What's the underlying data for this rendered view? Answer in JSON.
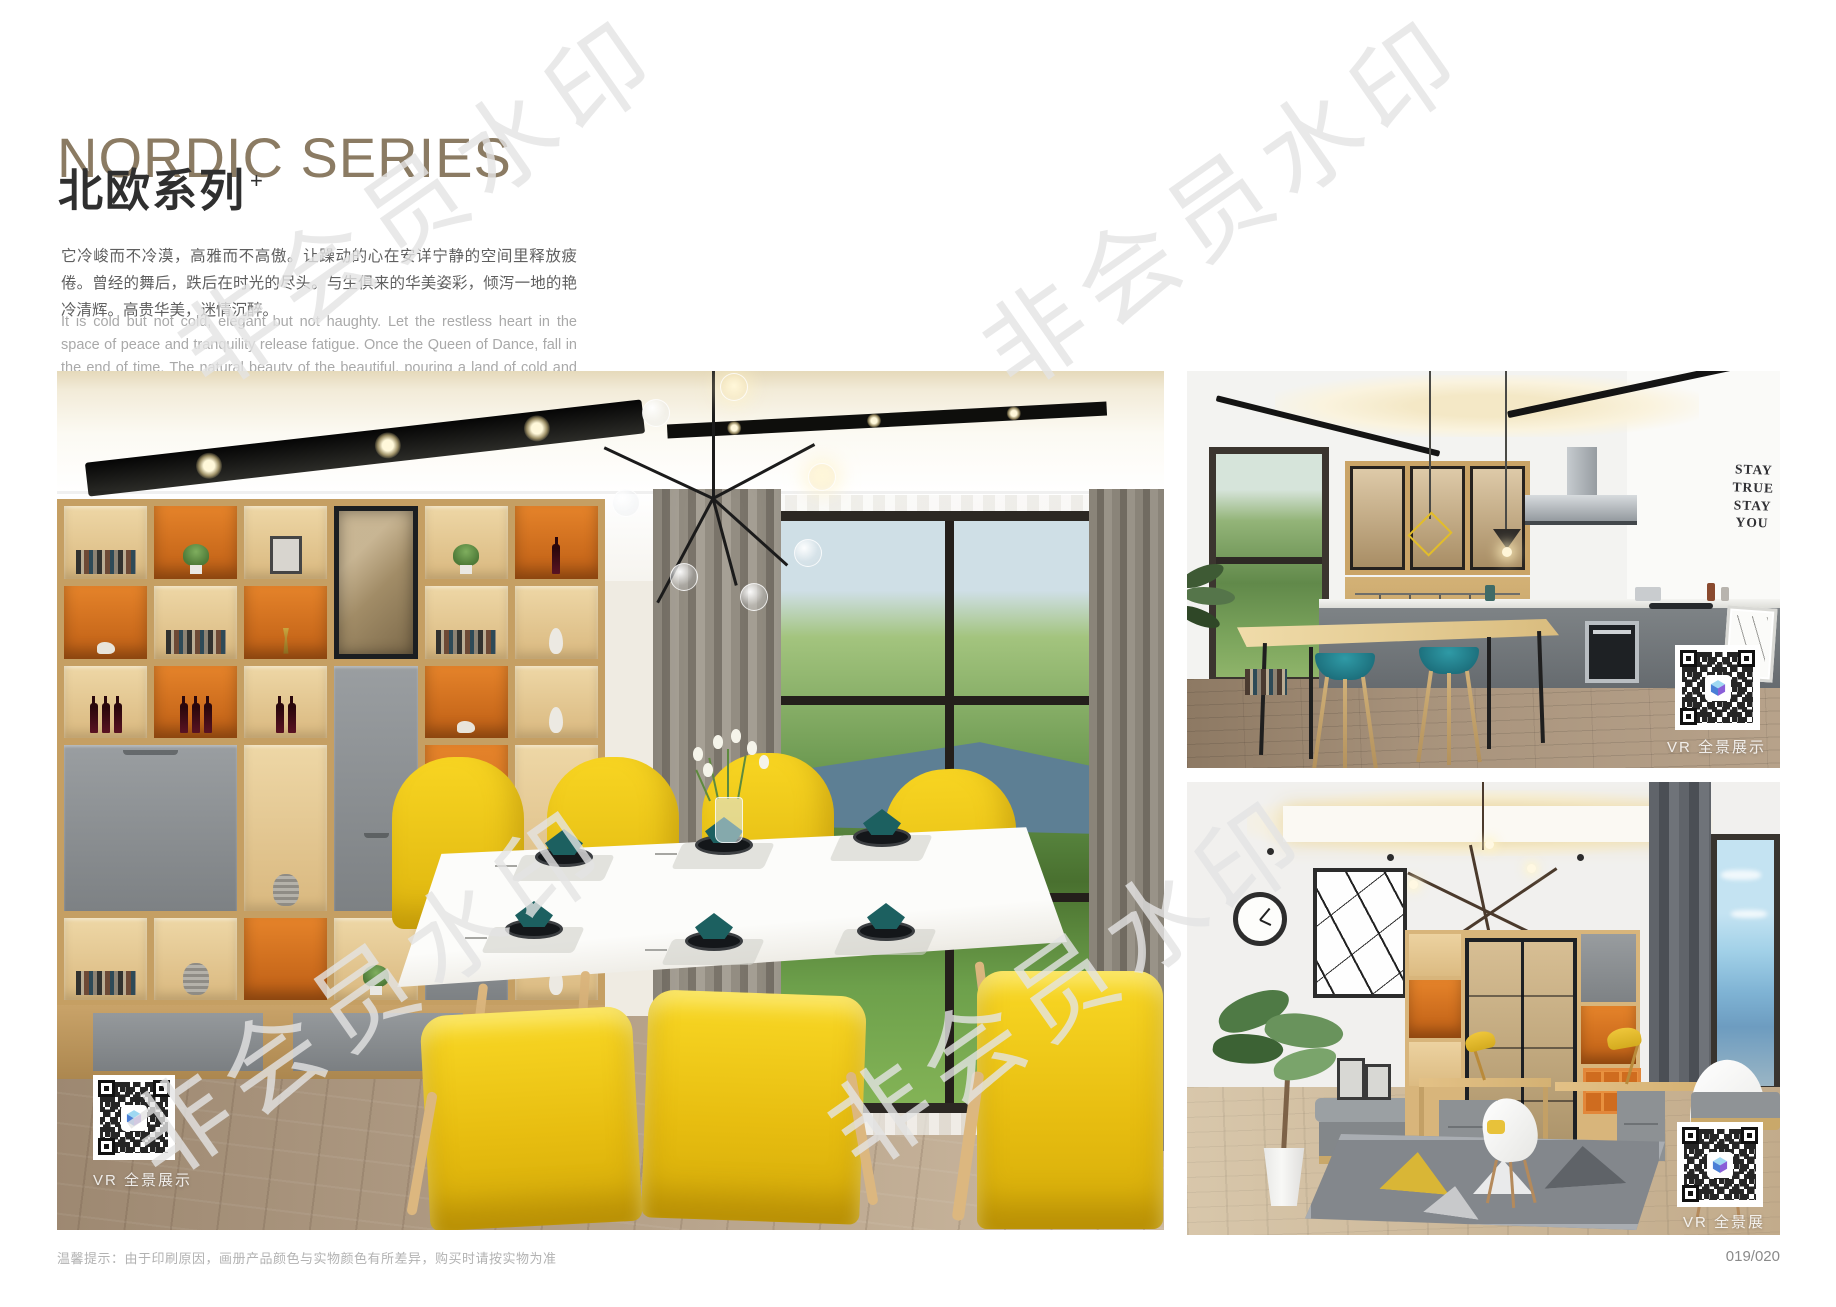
{
  "header": {
    "title_en": "NORDIC SERIES",
    "title_cn": "北欧系列",
    "title_sup": "+",
    "desc_cn": "它冷峻而不冷漠，高雅而不高傲。让躁动的心在安详宁静的空间里释放疲倦。曾经的舞后，跌后在时光的尽头。与生俱来的华美姿彩，倾泻一地的艳冷清辉。高贵华美，迷情沉醉。",
    "desc_en": "It is cold but not cold, elegant but not haughty. Let the restless heart in the space of peace and tranquility release fatigue. Once the Queen of Dance, fall in the end of time. The natural beauty of the beautiful, pouring a land of cold and pure brilliance. Noble, beautiful, enchanted."
  },
  "watermark": {
    "text": "非会员水印"
  },
  "photos": {
    "dining": {
      "caption": "VR 全景展示"
    },
    "kitchen": {
      "caption": "VR 全景展示",
      "wall_art": [
        "STAY",
        "TRUE",
        "STAY",
        "YOU"
      ]
    },
    "study": {
      "caption": "VR 全景展示"
    }
  },
  "footer": {
    "notice": "温馨提示：由于印刷原因，画册产品颜色与实物颜色有所差异，购买时请按实物为准",
    "page_number": "019/020"
  },
  "colors": {
    "title_brown": "#8b7b63",
    "accent_orange": "#cf6c1f",
    "chair_yellow": "#f6cd1c",
    "stool_teal": "#22808e",
    "shelf_wood": "#d2ae74",
    "watermark_gray": "#e3e3e3"
  }
}
